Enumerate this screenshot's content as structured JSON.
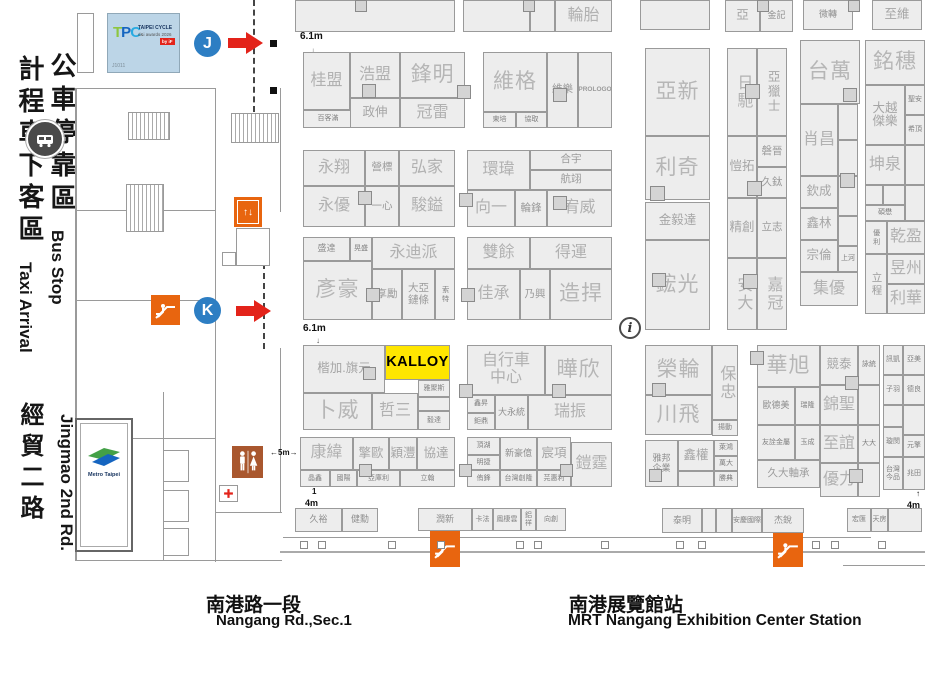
{
  "venue": {
    "hall_streets": {
      "nangang_zh": "南港路一段",
      "nangang_en": "Nangang Rd.,Sec.1",
      "mrt_zh": "南港展覽館站",
      "mrt_en": "MRT Nangang Exhibition Center Station"
    },
    "left_labels": {
      "bus_zh": "公車停靠區",
      "bus_en": "Bus Stop",
      "taxi_zh": "計程車下客區",
      "taxi_en": "Taxi Arrival",
      "road_zh": "經貿二路",
      "road_en": "Jingmao 2nd Rd."
    },
    "tpc_logo": {
      "logo_t": "T",
      "logo_p": "P",
      "logo_c": "C",
      "title": "TAIPEI CYCLE",
      "subtitle": "d&i awards 2026",
      "chip": "by iF",
      "code": "J1011"
    },
    "metro": {
      "label": "Metro Taipei"
    },
    "markers": {
      "gate_j": "J",
      "gate_k": "K",
      "info": "i"
    },
    "measurements": {
      "aisle_top": "6.1m",
      "aisle_mid": "6.1m",
      "aisle_5m": "←5m→",
      "one": "1",
      "four_left": "4m",
      "four_right": "4m",
      "arrow_up": "↑",
      "arrow_down": "↓"
    },
    "colors": {
      "booth_fill": "#ededed",
      "booth_border": "#9a9a9a",
      "highlight_yellow": "#ffe600",
      "marker_blue": "#2d7ec3",
      "arrow_red": "#e3231a",
      "icon_orange": "#e8650f",
      "restroom_brown": "#a9572e"
    },
    "highlight_booth": "KALLOY",
    "booths": [
      [
        "",
        295,
        0,
        160,
        32,
        "md"
      ],
      [
        "",
        463,
        0,
        67,
        32,
        "md"
      ],
      [
        "",
        530,
        0,
        25,
        32,
        "md"
      ],
      [
        "輪胎",
        555,
        0,
        57,
        32,
        "lg"
      ],
      [
        "",
        640,
        0,
        70,
        30,
        "md"
      ],
      [
        "亞",
        725,
        0,
        35,
        32,
        "md"
      ],
      [
        "金記",
        760,
        0,
        33,
        32,
        "xs"
      ],
      [
        "微轉",
        803,
        0,
        50,
        30,
        "xs"
      ],
      [
        "至維",
        872,
        0,
        50,
        30,
        "md"
      ],
      [
        "桂盟",
        303,
        52,
        47,
        58,
        "lg"
      ],
      [
        "百客滿",
        303,
        110,
        50,
        18,
        "xxs"
      ],
      [
        "浩盟",
        350,
        52,
        50,
        46,
        "lg"
      ],
      [
        "政伸",
        350,
        98,
        50,
        30,
        "md"
      ],
      [
        "鋒明",
        400,
        52,
        65,
        46,
        "xl"
      ],
      [
        "冠雷",
        400,
        98,
        65,
        30,
        "lg"
      ],
      [
        "維格",
        483,
        52,
        64,
        60,
        "xl"
      ],
      [
        "東培",
        483,
        112,
        33,
        16,
        "xxs"
      ],
      [
        "協取",
        516,
        112,
        31,
        16,
        "xxs"
      ],
      [
        "維樂",
        547,
        52,
        31,
        76,
        "sm"
      ],
      [
        "PROLOGO",
        578,
        52,
        34,
        76,
        "prologo"
      ],
      [
        "永翔",
        303,
        150,
        62,
        36,
        "lg"
      ],
      [
        "營標",
        365,
        150,
        34,
        36,
        "sm"
      ],
      [
        "弘家",
        399,
        150,
        56,
        36,
        "lg"
      ],
      [
        "永優",
        303,
        186,
        62,
        41,
        "lg"
      ],
      [
        "一心",
        365,
        186,
        34,
        41,
        "sm"
      ],
      [
        "駿鎰",
        399,
        186,
        56,
        41,
        "lg"
      ],
      [
        "環瑋",
        467,
        150,
        63,
        40,
        "lg"
      ],
      [
        "合宇",
        530,
        150,
        82,
        20,
        "sm"
      ],
      [
        "航翊",
        530,
        170,
        82,
        20,
        "sm"
      ],
      [
        "向一",
        467,
        190,
        48,
        37,
        "lg"
      ],
      [
        "輪鋒",
        515,
        190,
        32,
        37,
        "sm"
      ],
      [
        "宥威",
        547,
        190,
        65,
        37,
        "lg"
      ],
      [
        "盛達",
        303,
        237,
        47,
        24,
        "xs"
      ],
      [
        "晃盛",
        350,
        237,
        22,
        24,
        "xxs"
      ],
      [
        "永迪派",
        372,
        237,
        83,
        32,
        "lg"
      ],
      [
        "彥豪",
        303,
        261,
        69,
        59,
        "xl"
      ],
      [
        "享勵",
        372,
        269,
        30,
        51,
        "sm"
      ],
      [
        "大亞\n鏈條",
        402,
        269,
        33,
        51,
        "sm"
      ],
      [
        "索特",
        435,
        269,
        20,
        51,
        "xxs v"
      ],
      [
        "雙餘",
        467,
        237,
        63,
        32,
        "lg"
      ],
      [
        "得運",
        530,
        237,
        82,
        32,
        "lg"
      ],
      [
        "佳承",
        467,
        269,
        53,
        51,
        "lg"
      ],
      [
        "乃興",
        520,
        269,
        30,
        51,
        "sm"
      ],
      [
        "造捍",
        550,
        269,
        62,
        51,
        "xl"
      ],
      [
        "楷加.旗元",
        303,
        345,
        82,
        48,
        "md"
      ],
      [
        "KALLOY",
        385,
        345,
        65,
        35,
        "kalloy"
      ],
      [
        "雅聚斯",
        418,
        380,
        32,
        17,
        "xxs"
      ],
      [
        "",
        418,
        397,
        32,
        14,
        "xxs"
      ],
      [
        "毅達",
        418,
        411,
        32,
        19,
        "xxs"
      ],
      [
        "卜威",
        303,
        393,
        69,
        37,
        "xl"
      ],
      [
        "哲三",
        372,
        393,
        46,
        37,
        "lg"
      ],
      [
        "自行車\n中心",
        467,
        345,
        78,
        50,
        "lg"
      ],
      [
        "曄欣",
        545,
        345,
        67,
        50,
        "xl"
      ],
      [
        "鑫昇",
        467,
        395,
        28,
        18,
        "xxs"
      ],
      [
        "鉅鼎",
        467,
        413,
        28,
        17,
        "xxs"
      ],
      [
        "大永統",
        495,
        395,
        33,
        35,
        "xs"
      ],
      [
        "瑞振",
        528,
        395,
        84,
        35,
        "lg"
      ],
      [
        "康緯",
        300,
        437,
        53,
        33,
        "lg"
      ],
      [
        "擎歐",
        353,
        437,
        36,
        33,
        "md"
      ],
      [
        "穎灃",
        389,
        437,
        28,
        33,
        "md"
      ],
      [
        "協達",
        417,
        437,
        38,
        33,
        "md"
      ],
      [
        "晶鑫",
        300,
        470,
        30,
        17,
        "xxs"
      ],
      [
        "國陽",
        330,
        470,
        27,
        17,
        "xxs"
      ],
      [
        "亞庫利",
        357,
        470,
        43,
        17,
        "xxs"
      ],
      [
        "立翰",
        400,
        470,
        55,
        17,
        "xxs"
      ],
      [
        "頂湖",
        467,
        437,
        33,
        18,
        "xxs"
      ],
      [
        "明捷",
        467,
        455,
        33,
        15,
        "xxs"
      ],
      [
        "新豪億",
        500,
        437,
        37,
        33,
        "xs"
      ],
      [
        "宸項",
        537,
        437,
        34,
        33,
        "md"
      ],
      [
        "鎧霆",
        571,
        442,
        41,
        45,
        "lg"
      ],
      [
        "侑鋒",
        467,
        470,
        33,
        17,
        "xxs"
      ],
      [
        "台灣創隆",
        500,
        470,
        37,
        17,
        "xxs"
      ],
      [
        "芫惠利",
        537,
        470,
        34,
        17,
        "xxs"
      ],
      [
        "久裕",
        295,
        508,
        47,
        24,
        "xs"
      ],
      [
        "健勳",
        342,
        508,
        36,
        24,
        "xs"
      ],
      [
        "潤新",
        418,
        508,
        54,
        23,
        "xs"
      ],
      [
        "卡法",
        472,
        508,
        21,
        23,
        "xxs"
      ],
      [
        "鳳棲雲",
        493,
        508,
        28,
        23,
        "xxs"
      ],
      [
        "鋁祥",
        521,
        508,
        15,
        23,
        "xxs"
      ],
      [
        "向創",
        536,
        508,
        30,
        23,
        "xxs"
      ],
      [
        "泰明",
        662,
        508,
        40,
        25,
        "xs"
      ],
      [
        "",
        702,
        508,
        14,
        25,
        "xxs"
      ],
      [
        "",
        716,
        508,
        16,
        25,
        "xxs"
      ],
      [
        "安慶國際",
        732,
        508,
        30,
        25,
        "xxs"
      ],
      [
        "杰銳",
        762,
        508,
        42,
        25,
        "xs"
      ],
      [
        "宏匯",
        847,
        508,
        24,
        24,
        "xxs"
      ],
      [
        "天房",
        871,
        508,
        17,
        24,
        "xxs"
      ],
      [
        "",
        888,
        508,
        34,
        24,
        "xxs"
      ],
      [
        "亞新",
        645,
        48,
        65,
        88,
        "xl"
      ],
      [
        "利奇",
        645,
        136,
        65,
        64,
        "xl"
      ],
      [
        "金毅達",
        645,
        202,
        65,
        38,
        "md"
      ],
      [
        "鋐光",
        645,
        240,
        65,
        90,
        "xl"
      ],
      [
        "日馳",
        727,
        48,
        30,
        88,
        "lg v"
      ],
      [
        "亞獵士",
        757,
        48,
        30,
        88,
        "md v"
      ],
      [
        "愷拓",
        727,
        136,
        30,
        62,
        "md"
      ],
      [
        "磐晉",
        757,
        136,
        30,
        31,
        "sm"
      ],
      [
        "久鈦",
        757,
        167,
        30,
        31,
        "sm"
      ],
      [
        "精創",
        727,
        198,
        30,
        60,
        "md"
      ],
      [
        "立志",
        757,
        198,
        30,
        60,
        "sm"
      ],
      [
        "安大",
        727,
        258,
        30,
        72,
        "lg v"
      ],
      [
        "嘉冠",
        757,
        258,
        30,
        72,
        "lg v"
      ],
      [
        "台萬",
        800,
        40,
        60,
        64,
        "xl"
      ],
      [
        "肖昌",
        800,
        104,
        38,
        72,
        "lg"
      ],
      [
        "",
        838,
        104,
        20,
        36,
        "xxs"
      ],
      [
        "",
        838,
        140,
        20,
        36,
        "xxs"
      ],
      [
        "欽成",
        800,
        176,
        38,
        32,
        "md"
      ],
      [
        "",
        838,
        176,
        20,
        40,
        "xxs"
      ],
      [
        "鑫林",
        800,
        208,
        38,
        32,
        "md"
      ],
      [
        "",
        838,
        216,
        20,
        30,
        "xxs"
      ],
      [
        "宗倫",
        800,
        240,
        38,
        32,
        "md"
      ],
      [
        "上河",
        838,
        246,
        20,
        26,
        "xxs"
      ],
      [
        "集優",
        800,
        272,
        58,
        34,
        "lg"
      ],
      [
        "銘穗",
        865,
        40,
        60,
        45,
        "xl"
      ],
      [
        "大越\n傑樂",
        865,
        85,
        40,
        60,
        "md"
      ],
      [
        "聖安",
        905,
        85,
        20,
        30,
        "xxs"
      ],
      [
        "希頂",
        905,
        115,
        20,
        30,
        "xxs"
      ],
      [
        "坤泉",
        865,
        145,
        40,
        40,
        "lg"
      ],
      [
        "",
        905,
        145,
        20,
        40,
        "xxs"
      ],
      [
        "",
        865,
        185,
        18,
        20,
        "xxs"
      ],
      [
        "",
        883,
        185,
        22,
        20,
        "xxs"
      ],
      [
        "",
        905,
        185,
        20,
        36,
        "xxs"
      ],
      [
        "碩懋",
        865,
        205,
        40,
        16,
        "xxs"
      ],
      [
        "優利",
        865,
        221,
        22,
        33,
        "xxs v"
      ],
      [
        "乾盈",
        887,
        221,
        38,
        33,
        "lg"
      ],
      [
        "立程",
        865,
        254,
        22,
        60,
        "sm v"
      ],
      [
        "昱州",
        887,
        254,
        38,
        30,
        "lg"
      ],
      [
        "利華",
        887,
        284,
        38,
        30,
        "lg"
      ],
      [
        "榮輪",
        645,
        345,
        67,
        50,
        "xl"
      ],
      [
        "川飛",
        645,
        395,
        67,
        40,
        "xl"
      ],
      [
        "保忠",
        712,
        345,
        26,
        75,
        "lg v"
      ],
      [
        "揚動",
        712,
        420,
        26,
        16,
        "xxs"
      ],
      [
        "雅邦\n企業",
        645,
        440,
        33,
        47,
        "xs"
      ],
      [
        "鑫權",
        678,
        440,
        36,
        31,
        "md"
      ],
      [
        "",
        678,
        471,
        36,
        16,
        "xxs"
      ],
      [
        "萊鴻",
        714,
        440,
        24,
        16,
        "xxs"
      ],
      [
        "萬大",
        714,
        456,
        24,
        15,
        "xxs"
      ],
      [
        "勝典",
        714,
        471,
        24,
        16,
        "xxs"
      ],
      [
        "華旭",
        757,
        345,
        63,
        42,
        "xl"
      ],
      [
        "歐德美",
        757,
        387,
        38,
        38,
        "xs"
      ],
      [
        "瑞隆",
        795,
        387,
        25,
        38,
        "xxs"
      ],
      [
        "友詮金屬",
        757,
        425,
        38,
        35,
        "xxs"
      ],
      [
        "玉成",
        795,
        425,
        25,
        35,
        "xxs"
      ],
      [
        "久大軸承",
        757,
        460,
        63,
        28,
        "sm"
      ],
      [
        "競泰",
        820,
        345,
        38,
        40,
        "md"
      ],
      [
        "詠統",
        858,
        345,
        22,
        40,
        "xxs"
      ],
      [
        "錦聖",
        820,
        385,
        38,
        40,
        "lg"
      ],
      [
        "",
        858,
        385,
        22,
        40,
        "xxs"
      ],
      [
        "至誼",
        820,
        425,
        38,
        38,
        "lg"
      ],
      [
        "大大",
        858,
        425,
        22,
        38,
        "xxs"
      ],
      [
        "優力",
        820,
        463,
        38,
        34,
        "lg"
      ],
      [
        "",
        858,
        463,
        22,
        34,
        "xxs"
      ],
      [
        "訊凱",
        883,
        345,
        20,
        30,
        "xxs"
      ],
      [
        "亞美",
        903,
        345,
        22,
        30,
        "xxs"
      ],
      [
        "子羽",
        883,
        375,
        20,
        30,
        "xxs"
      ],
      [
        "德良",
        903,
        375,
        22,
        30,
        "xxs"
      ],
      [
        "",
        883,
        405,
        20,
        22,
        "xxs"
      ],
      [
        "",
        903,
        405,
        22,
        30,
        "xxs"
      ],
      [
        "璇閔",
        883,
        427,
        20,
        30,
        "xxs"
      ],
      [
        "元擎",
        903,
        435,
        22,
        22,
        "xxs"
      ],
      [
        "台灣\n今品",
        883,
        457,
        20,
        33,
        "xxs"
      ],
      [
        "兆田",
        903,
        457,
        22,
        33,
        "xxs"
      ]
    ],
    "column_squares": [
      [
        355,
        0,
        12
      ],
      [
        523,
        0,
        12
      ],
      [
        757,
        0,
        12
      ],
      [
        848,
        0,
        12
      ],
      [
        362,
        84,
        14
      ],
      [
        457,
        85,
        14
      ],
      [
        553,
        88,
        14
      ],
      [
        358,
        191,
        14
      ],
      [
        459,
        193,
        14
      ],
      [
        553,
        196,
        14
      ],
      [
        366,
        288,
        14
      ],
      [
        461,
        288,
        14
      ],
      [
        363,
        367,
        13
      ],
      [
        459,
        384,
        14
      ],
      [
        552,
        384,
        14
      ],
      [
        359,
        464,
        13
      ],
      [
        459,
        464,
        13
      ],
      [
        560,
        464,
        13
      ],
      [
        650,
        186,
        15
      ],
      [
        652,
        273,
        14
      ],
      [
        745,
        84,
        15
      ],
      [
        747,
        181,
        15
      ],
      [
        743,
        274,
        15
      ],
      [
        843,
        88,
        14
      ],
      [
        840,
        173,
        15
      ],
      [
        652,
        383,
        14
      ],
      [
        649,
        469,
        13
      ],
      [
        750,
        351,
        14
      ],
      [
        845,
        376,
        14
      ],
      [
        849,
        469,
        14
      ]
    ],
    "black_squares": [
      [
        270,
        40,
        7
      ],
      [
        270,
        87,
        7
      ]
    ]
  }
}
